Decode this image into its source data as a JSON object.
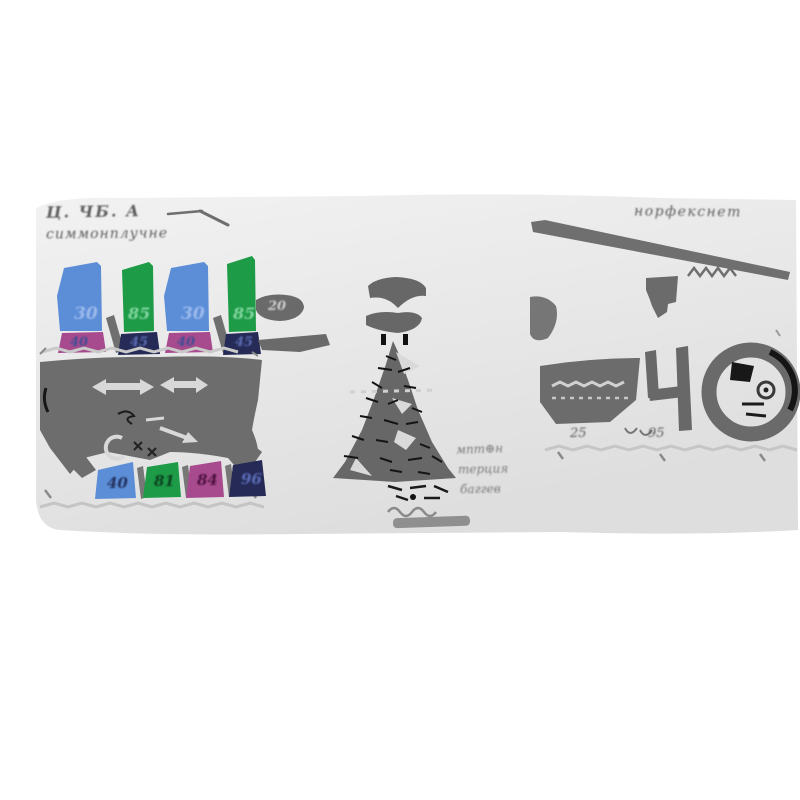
{
  "figure": {
    "background": "#ffffff",
    "band_top_color": "#f2f2f2",
    "band_bottom_color": "#dedede",
    "ink": "#6a6a6a",
    "palette": {
      "blue": "#5c8ed8",
      "green": "#1d9b47",
      "magenta": "#a74b8e",
      "navy": "#252b56",
      "light_ink": "#d8d8d8",
      "black": "#1a1a1a"
    },
    "left_panel": {
      "title_line1": "Ц. ЧБ. А",
      "title_line2": "симмонплучне",
      "pair1": {
        "blue": "30",
        "magenta": "40",
        "green": "85",
        "navy": "45"
      },
      "pair2": {
        "blue": "30",
        "magenta": "40",
        "green": "85",
        "navy": "45"
      },
      "bottom_row": {
        "blue": "40",
        "green": "81",
        "magenta": "84",
        "navy": "96"
      }
    },
    "middle_panel": {
      "link_value": "20",
      "note_line1": "мпт⊕н",
      "note_line2": "терция",
      "note_line3": "баггев"
    },
    "right_panel": {
      "title": "норфекснет",
      "value_left": "25",
      "value_right": "95"
    }
  }
}
